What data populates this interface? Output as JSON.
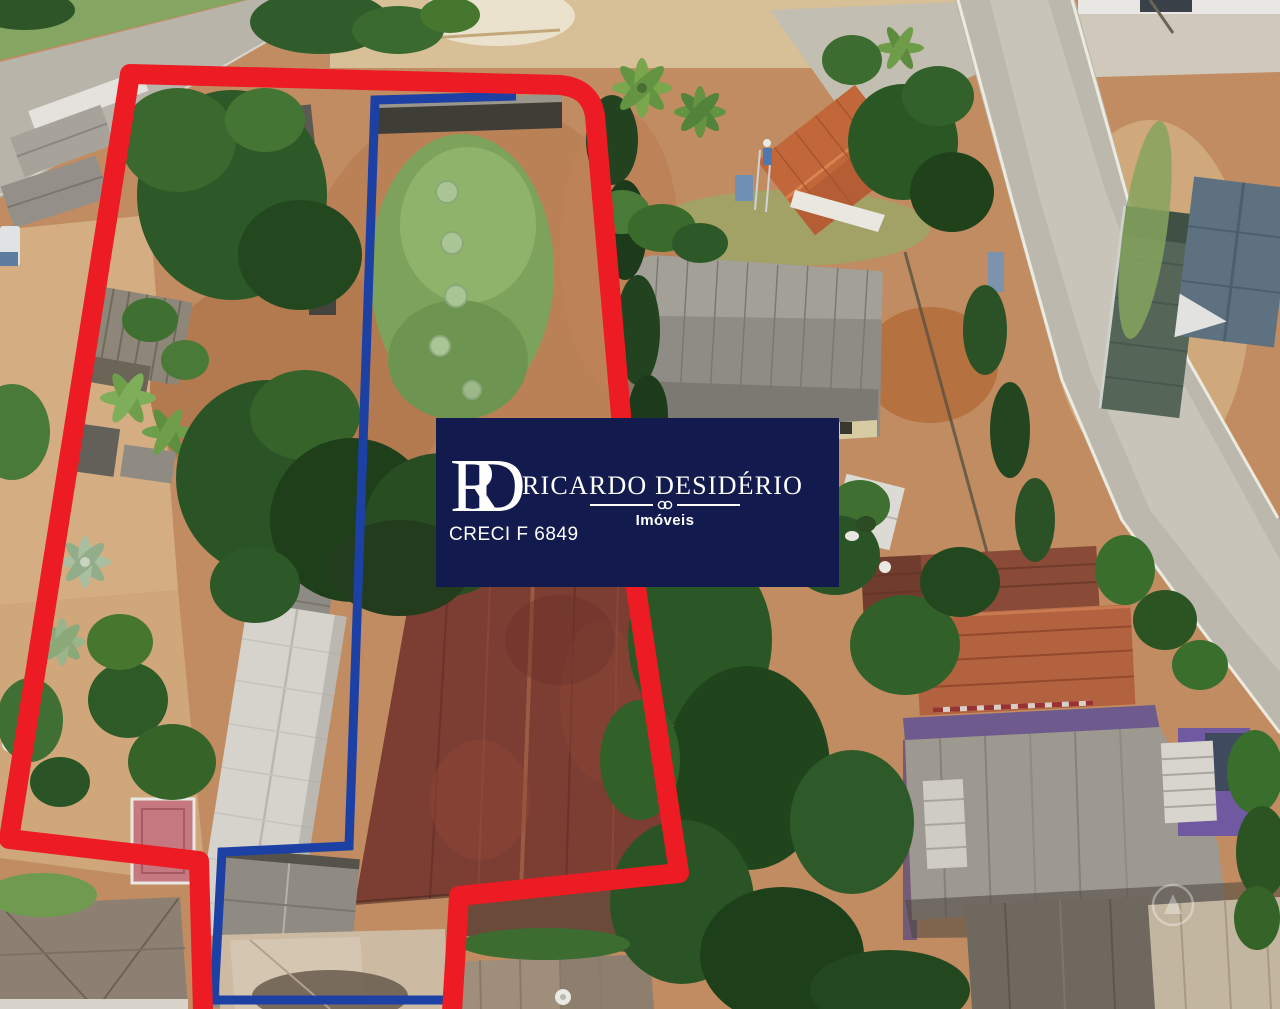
{
  "overlays": {
    "outer_boundary_color": "#ec1b24",
    "inner_boundary_color": "#1d40a5"
  },
  "logo": {
    "background_color": "#131b4e",
    "text_color": "#ffffff",
    "monogram_letter1": "R",
    "monogram_letter2": "D",
    "name": "RICARDO DESIDÉRIO",
    "subtitle": "Imóveis",
    "license": "CRECI F 6849"
  }
}
